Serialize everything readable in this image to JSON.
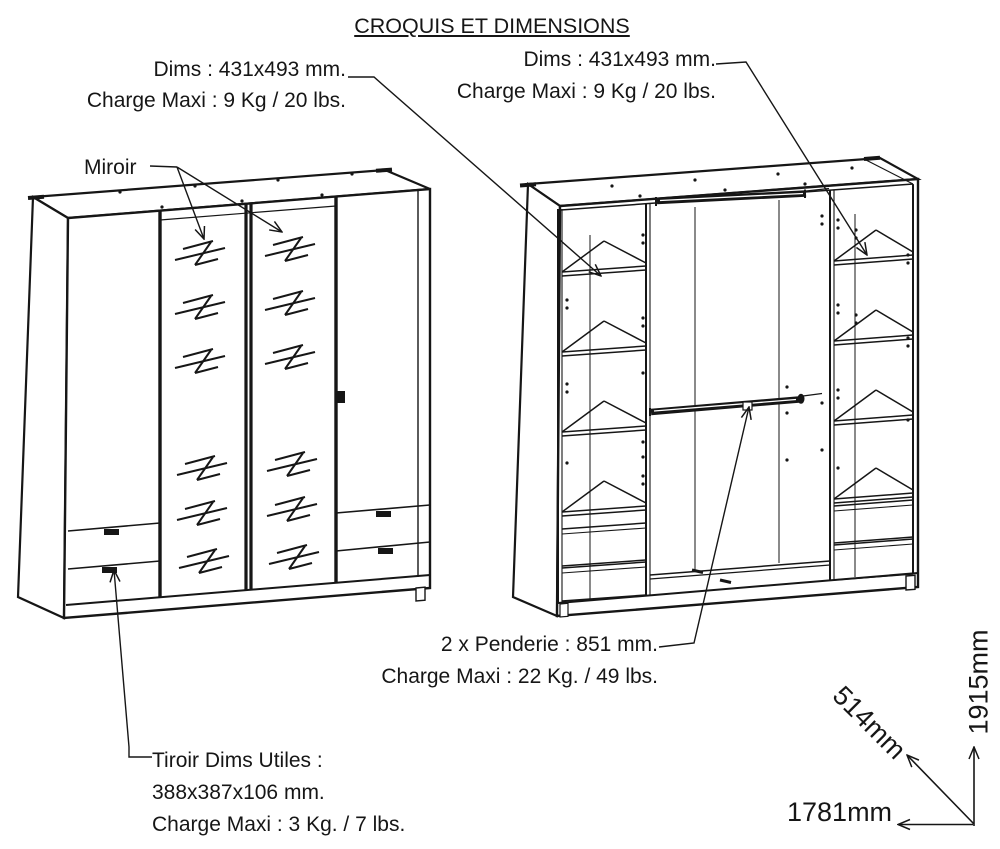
{
  "title": "CROQUIS ET DIMENSIONS",
  "annotations": {
    "dims_left": {
      "lines": [
        "Dims : 431x493 mm.",
        "Charge Maxi : 9 Kg / 20 lbs."
      ]
    },
    "dims_right": {
      "lines": [
        "Dims : 431x493 mm.",
        "Charge Maxi : 9 Kg / 20 lbs."
      ]
    },
    "miroir": "Miroir",
    "penderie": {
      "lines": [
        "2 x Penderie : 851 mm.",
        "Charge Maxi : 22 Kg. / 49 lbs."
      ]
    },
    "tiroir": {
      "lines": [
        "Tiroir Dims Utiles :",
        "388x387x106 mm.",
        "Charge Maxi : 3 Kg. / 7 lbs."
      ]
    }
  },
  "dimensions": {
    "width_label": "1781mm",
    "height_label": "1915mm",
    "depth_label": "514mm"
  },
  "colors": {
    "ink": "#161616",
    "background": "#ffffff"
  }
}
